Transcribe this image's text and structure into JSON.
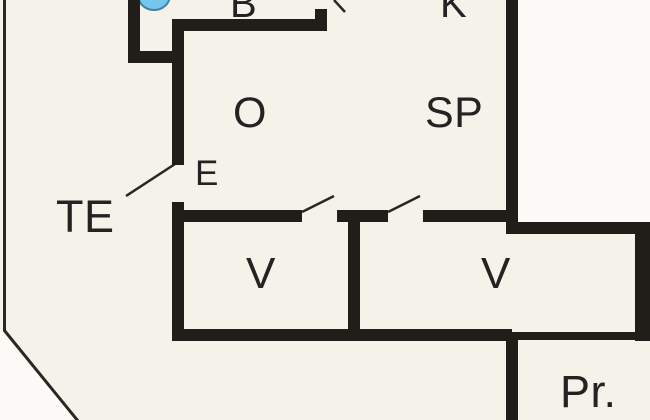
{
  "floorplan": {
    "type": "apartment-floor-plan-crop",
    "rooms": {
      "room_b": {
        "label": "B"
      },
      "room_k": {
        "label": "K"
      },
      "room_o": {
        "label": "O"
      },
      "room_sp": {
        "label": "SP"
      },
      "room_e": {
        "label": "E"
      },
      "room_te": {
        "label": "TE"
      },
      "room_v1": {
        "label": "V"
      },
      "room_v2": {
        "label": "V"
      },
      "room_pr": {
        "label": "Pr."
      }
    },
    "features": {
      "sink_icon": "sink-basin-half-ellipse",
      "door_swings": 4,
      "terrace_edge": "thin-line-with-diagonal-corner"
    },
    "colors": {
      "wall": "#211d18",
      "interior": "#f5f2ea",
      "exterior": "#fcfbf8",
      "line": "#2a2723",
      "label": "#232323",
      "sink_fill": "#74c6ec",
      "sink_stroke": "#47809f"
    }
  }
}
